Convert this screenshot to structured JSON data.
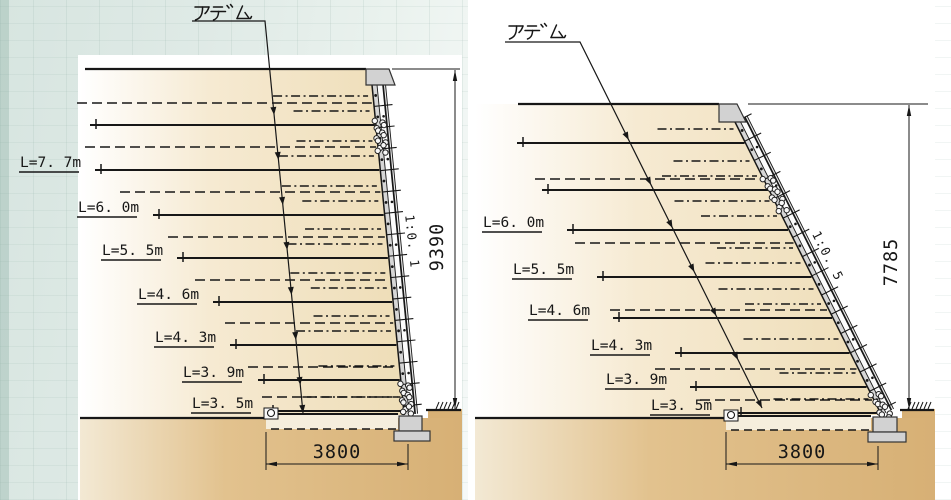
{
  "drawing": {
    "colors": {
      "line": "#171717",
      "paper": "#ffffff",
      "soil_mid": "#f6ead2",
      "soil_deep": "#eeddb7",
      "ground_fill": "#d7b075",
      "ground_mid": "#e2c28e",
      "ground_light": "#f5eedd",
      "concrete_fill": "#d2d2d2",
      "facing_gray": "#d6d6d6",
      "facing_white": "#fcfcfc"
    },
    "sections": [
      {
        "name": "left-wall-section",
        "callout": "アデム",
        "slope_ratio": "1:0. 1",
        "height_dimension": "9390",
        "width_dimension": "3800",
        "nail_rows": [
          {
            "label": ""
          },
          {
            "label": "L=7. 7m"
          },
          {
            "label": "L=6. 0m"
          },
          {
            "label": "L=5. 5m"
          },
          {
            "label": "L=4. 6m"
          },
          {
            "label": "L=4. 3m"
          },
          {
            "label": "L=3. 9m"
          },
          {
            "label": "L=3. 5m"
          }
        ]
      },
      {
        "name": "right-wall-section",
        "callout": "アデム",
        "slope_ratio": "1:0. 5",
        "height_dimension": "7785",
        "width_dimension": "3800",
        "nail_rows": [
          {
            "label": ""
          },
          {
            "label": ""
          },
          {
            "label": "L=6. 0m"
          },
          {
            "label": "L=5. 5m"
          },
          {
            "label": "L=4. 6m"
          },
          {
            "label": "L=4. 3m"
          },
          {
            "label": "L=3. 9m"
          },
          {
            "label": "L=3. 5m"
          }
        ]
      }
    ]
  }
}
